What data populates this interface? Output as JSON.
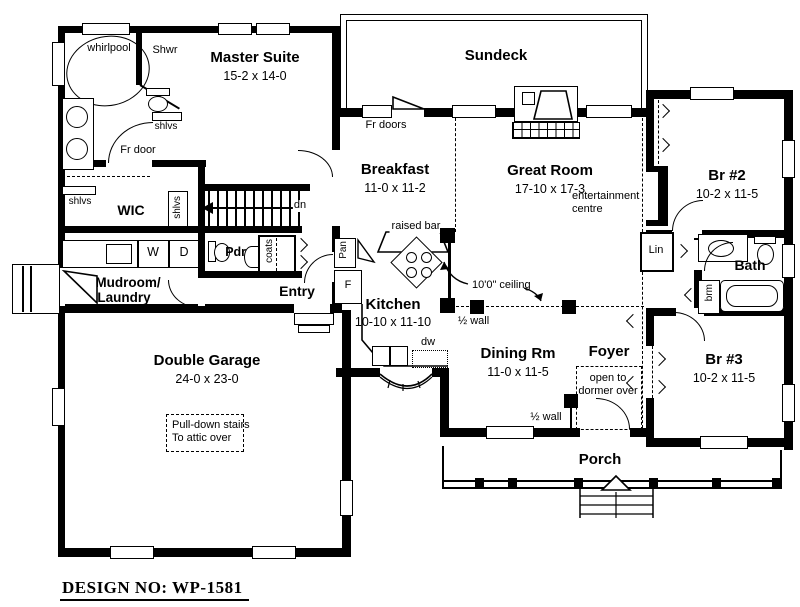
{
  "design_no": "DESIGN NO: WP-1581",
  "rooms": {
    "master_suite": {
      "name": "Master Suite",
      "dims": "15-2 x 14-0"
    },
    "sundeck": {
      "name": "Sundeck"
    },
    "breakfast": {
      "name": "Breakfast",
      "dims": "11-0 x 11-2"
    },
    "great_room": {
      "name": "Great Room",
      "dims": "17-10 x 17-3"
    },
    "br2": {
      "name": "Br #2",
      "dims": "10-2 x 11-5"
    },
    "bath": {
      "name": "Bath"
    },
    "br3": {
      "name": "Br #3",
      "dims": "10-2 x 11-5"
    },
    "kitchen": {
      "name": "Kitchen",
      "dims": "10-10 x 11-10"
    },
    "dining": {
      "name": "Dining Rm",
      "dims": "11-0 x 11-5"
    },
    "foyer": {
      "name": "Foyer"
    },
    "entry": {
      "name": "Entry"
    },
    "wic": {
      "name": "WIC"
    },
    "mudroom": {
      "line1": "Mudroom/",
      "line2": "Laundry"
    },
    "pdr": {
      "name": "Pdr."
    },
    "garage": {
      "name": "Double Garage",
      "dims": "24-0 x 23-0"
    },
    "porch": {
      "name": "Porch"
    }
  },
  "labels": {
    "whirlpool": "whirlpool",
    "shwr": "Shwr",
    "shlvs": "shlvs",
    "fr_door": "Fr door",
    "fr_doors": "Fr doors",
    "dn": "dn",
    "washer": "W",
    "dryer": "D",
    "coats": "coats",
    "pan": "Pan",
    "fridge": "F",
    "raised_bar": "raised bar",
    "dw": "dw",
    "half_wall": "½ wall",
    "ceiling_height": "10'0\" ceiling",
    "ent_line1": "entertainment",
    "ent_line2": "centre",
    "lin": "Lin",
    "brm": "brm",
    "dormer_line1": "open to",
    "dormer_line2": "dormer over",
    "attic_line1": "Pull-down stairs",
    "attic_line2": "To attic over"
  },
  "colors": {
    "line": "#000000",
    "background": "#ffffff"
  }
}
